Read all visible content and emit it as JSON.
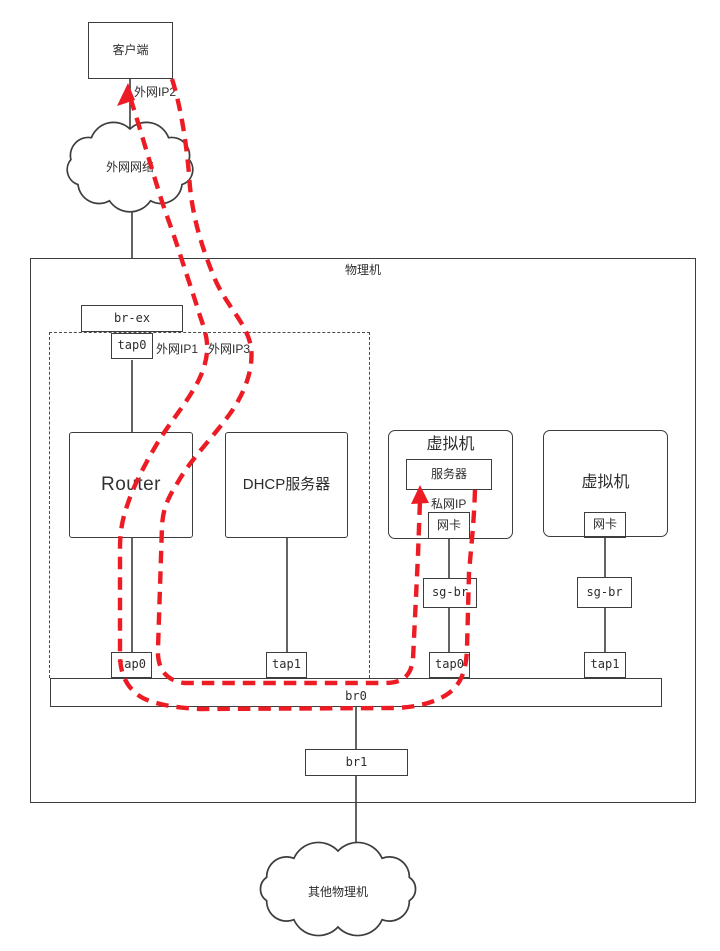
{
  "colors": {
    "accent_red": "#ed1c24",
    "line_dark": "#3d3d3d"
  },
  "labels": {
    "client": "客户端",
    "wan_ip2": "外网IP2",
    "external_network": "外网网络",
    "physical_machine": "物理机",
    "br_ex": "br-ex",
    "ns_tap0": "tap0",
    "wan_ip1": "外网IP1",
    "wan_ip3": "外网IP3",
    "router": "Router",
    "dhcp_server": "DHCP服务器",
    "vm1": "虚拟机",
    "server": "服务器",
    "private_ip": "私网IP",
    "nic1": "网卡",
    "sg_br1": "sg-br",
    "vm1_tap0": "tap0",
    "vm2": "虚拟机",
    "nic2": "网卡",
    "sg_br2": "sg-br",
    "vm2_tap1": "tap1",
    "host_tap0": "tap0",
    "host_tap1": "tap1",
    "br0": "br0",
    "br1": "br1",
    "other_physical_machines": "其他物理机"
  }
}
